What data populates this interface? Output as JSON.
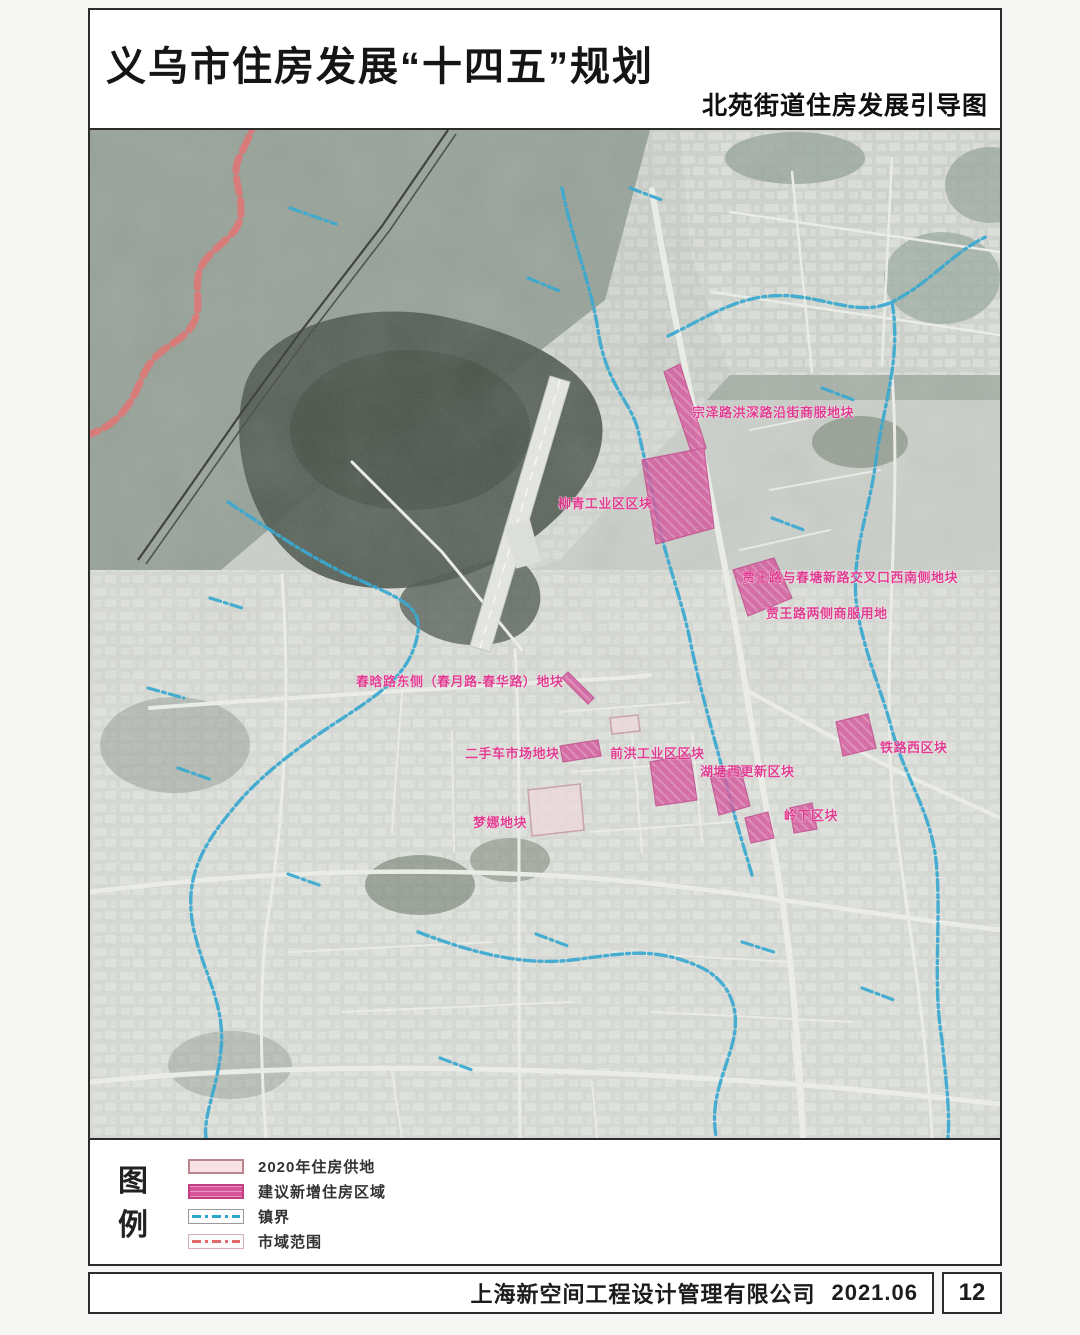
{
  "header": {
    "title": "义乌市住房发展“十四五”规划",
    "subtitle": "北苑街道住房发展引导图"
  },
  "map": {
    "labels": [
      {
        "text": "宗泽路洪深路沿街商服地块"
      },
      {
        "text": "柳青工业区区块"
      },
      {
        "text": "贾王路与春塘新路交叉口西南侧地块"
      },
      {
        "text": "贾王路两侧商服用地"
      },
      {
        "text": "春晗路东侧（春月路-春华路）地块"
      },
      {
        "text": "二手车市场地块"
      },
      {
        "text": "前洪工业区区块"
      },
      {
        "text": "湖塘西更新区块"
      },
      {
        "text": "铁路西区块"
      },
      {
        "text": "岭下区块"
      },
      {
        "text": "梦娜地块"
      }
    ]
  },
  "legend": {
    "heading": "图例",
    "items": [
      {
        "label": "2020年住房供地",
        "color": "#f7e2e6",
        "border": "#b9868f"
      },
      {
        "label": "建议新增住房区域",
        "color": "#d8549a"
      },
      {
        "label": "镇界",
        "color": "#2aa7d0"
      },
      {
        "label": "市域范围",
        "color": "#e06a6a"
      }
    ]
  },
  "footer": {
    "company": "上海新空间工程设计管理有限公司",
    "date": "2021.06",
    "page_number": "12"
  }
}
